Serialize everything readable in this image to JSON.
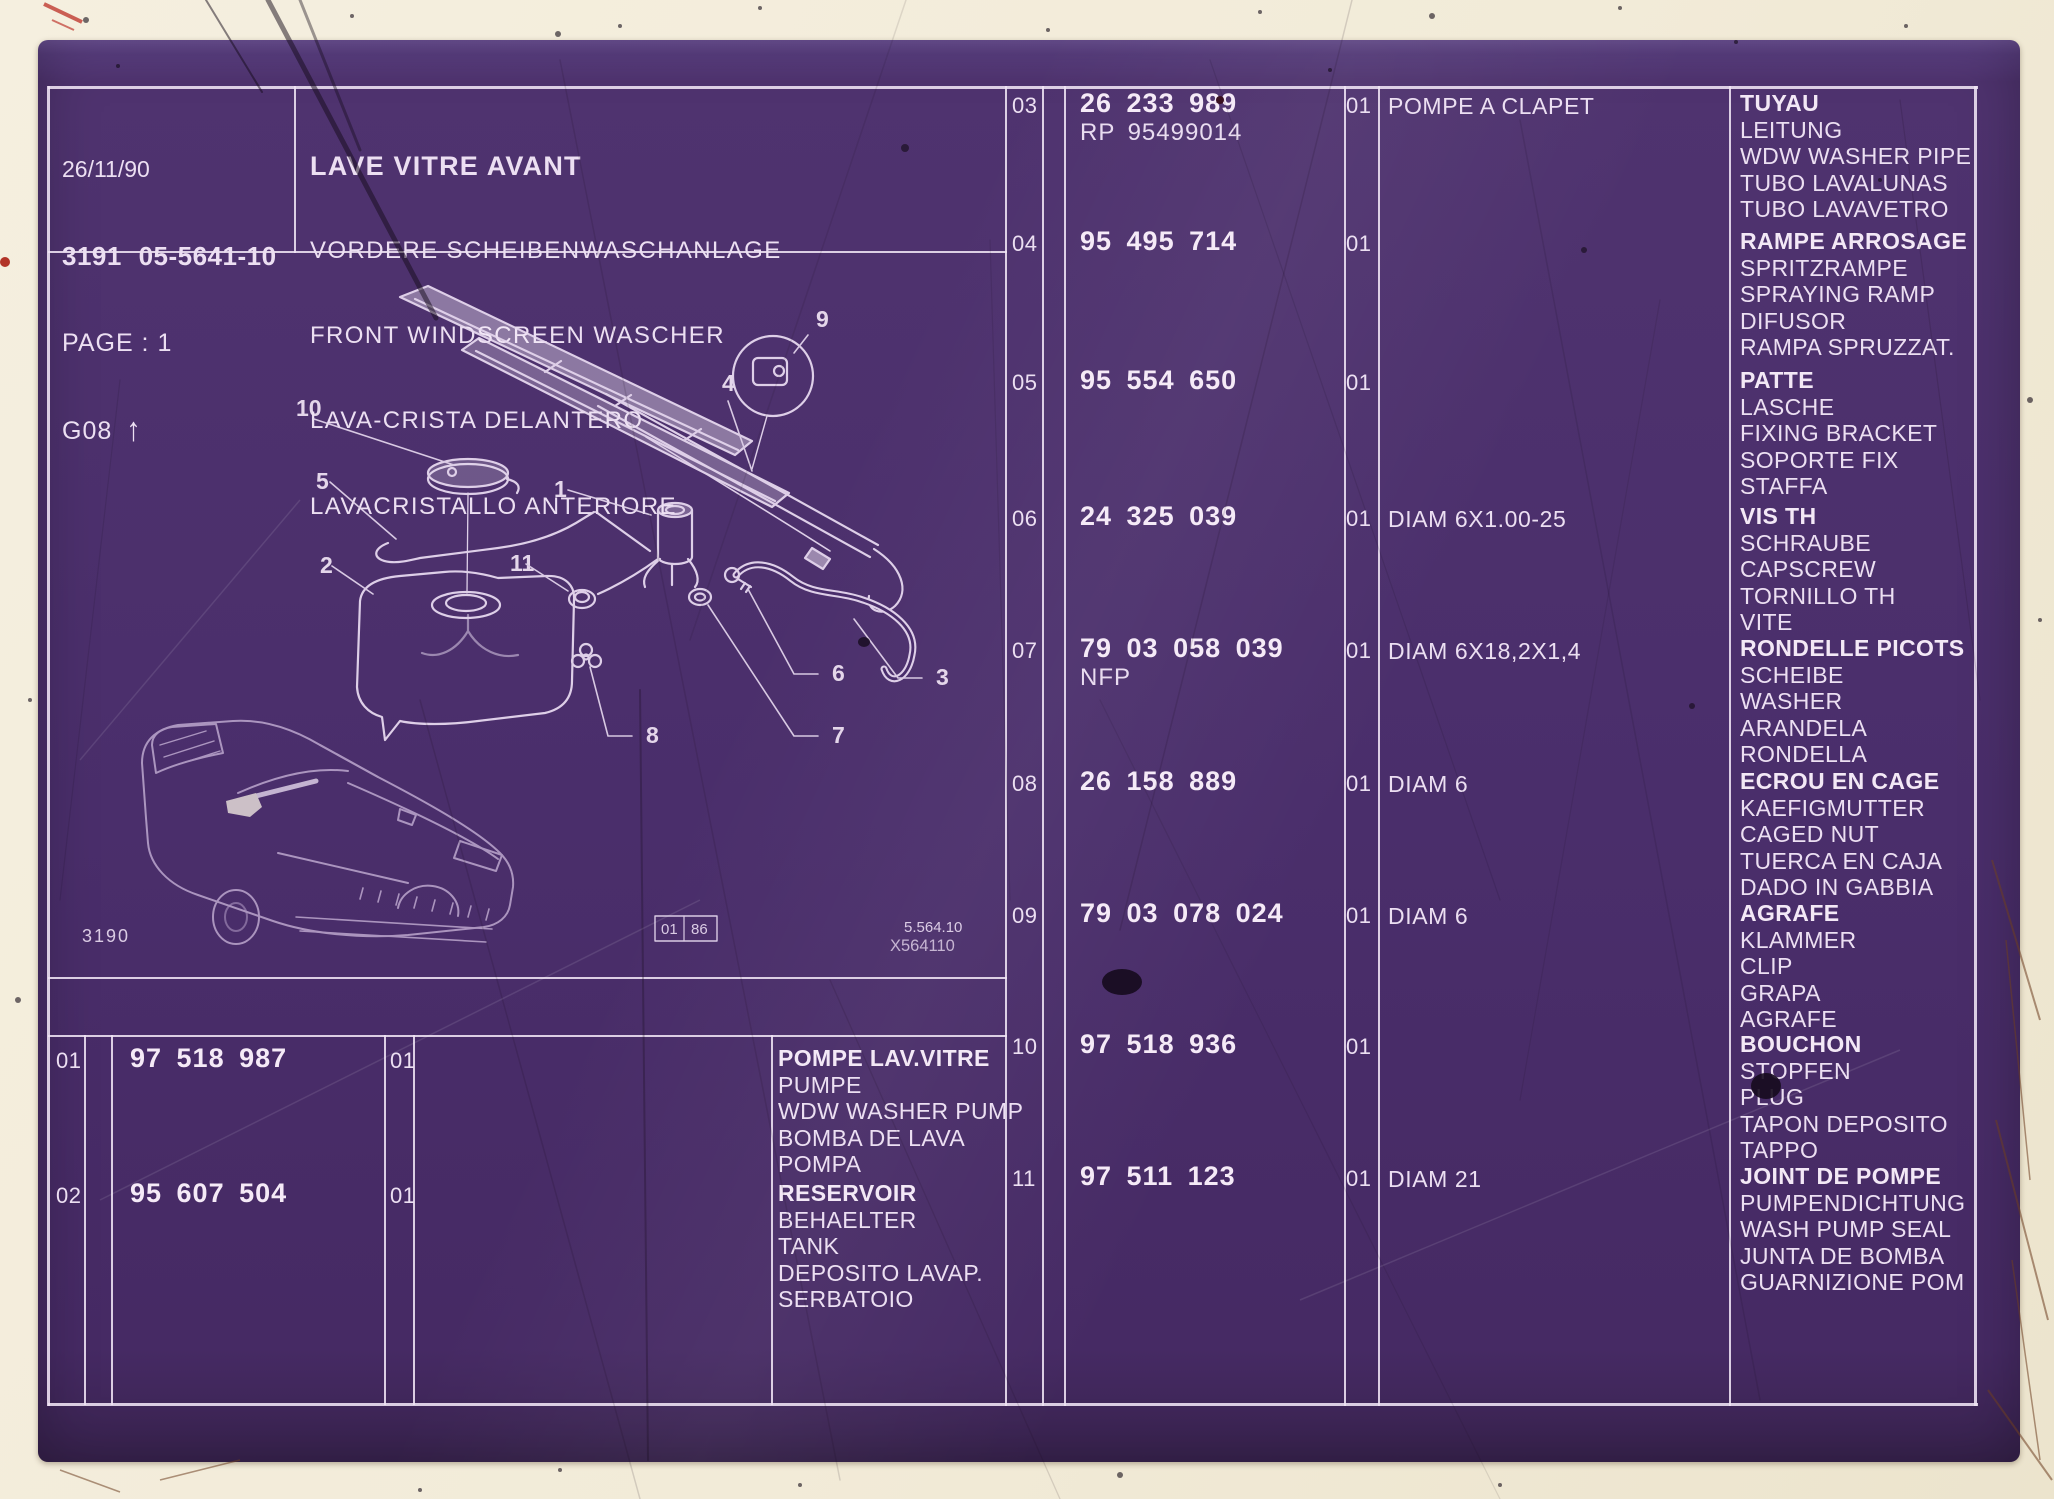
{
  "header": {
    "date": "26/11/90",
    "document_code": "3191 05-5641-10",
    "page": "PAGE : 1",
    "grid_ref": "G08",
    "grid_arrow": "↑"
  },
  "title": {
    "lines": [
      "LAVE VITRE AVANT",
      "VORDERE SCHEIBENWASCHANLAGE",
      "FRONT WINDSCREEN WASCHER",
      "LAVA-CRISTA DELANTERO",
      "LAVACRISTALLO ANTERIORE"
    ]
  },
  "drawing": {
    "callouts": [
      "1",
      "2",
      "3",
      "4",
      "5",
      "6",
      "7",
      "8",
      "9",
      "10",
      "11"
    ],
    "figure_number": "3190",
    "date_box_left": "01",
    "date_box_right": "86",
    "plate_ref_line1": "5.564.10",
    "plate_ref_line2": "X564110"
  },
  "parts_table_left": {
    "rows": [
      {
        "ref": "01",
        "part_lines": [
          "97 518 987"
        ],
        "qty": "01",
        "note": "",
        "descriptions": [
          "POMPE LAV.VITRE",
          "PUMPE",
          "WDW WASHER PUMP",
          "BOMBA DE LAVA",
          "POMPA"
        ]
      },
      {
        "ref": "02",
        "part_lines": [
          "95 607 504"
        ],
        "qty": "01",
        "note": "",
        "descriptions": [
          "RESERVOIR",
          "BEHAELTER",
          "TANK",
          "DEPOSITO LAVAP.",
          "SERBATOIO"
        ]
      }
    ]
  },
  "parts_table_right": {
    "rows": [
      {
        "ref": "03",
        "part_lines": [
          "26 233 989",
          "RP 95499014"
        ],
        "qty": "01",
        "note": "POMPE A CLAPET",
        "descriptions": [
          "TUYAU",
          "LEITUNG",
          "WDW WASHER PIPE",
          "TUBO LAVALUNAS",
          "TUBO LAVAVETRO"
        ]
      },
      {
        "ref": "04",
        "part_lines": [
          "95 495 714"
        ],
        "qty": "01",
        "note": "",
        "descriptions": [
          "RAMPE ARROSAGE",
          "SPRITZRAMPE",
          "SPRAYING RAMP",
          "DIFUSOR",
          "RAMPA SPRUZZAT."
        ]
      },
      {
        "ref": "05",
        "part_lines": [
          "95 554 650"
        ],
        "qty": "01",
        "note": "",
        "descriptions": [
          "PATTE",
          "LASCHE",
          "FIXING BRACKET",
          "SOPORTE FIX",
          "STAFFA"
        ]
      },
      {
        "ref": "06",
        "part_lines": [
          "24 325 039"
        ],
        "qty": "01",
        "note": "DIAM 6X1.00-25",
        "descriptions": [
          "VIS TH",
          "SCHRAUBE",
          "CAPSCREW",
          "TORNILLO TH",
          "VITE"
        ]
      },
      {
        "ref": "07",
        "part_lines": [
          "79 03 058 039",
          "NFP"
        ],
        "qty": "01",
        "note": "DIAM 6X18,2X1,4",
        "descriptions": [
          "RONDELLE PICOTS",
          "SCHEIBE",
          "WASHER",
          "ARANDELA",
          "RONDELLA"
        ]
      },
      {
        "ref": "08",
        "part_lines": [
          "26 158 889"
        ],
        "qty": "01",
        "note": "DIAM 6",
        "descriptions": [
          "ECROU EN CAGE",
          "KAEFIGMUTTER",
          "CAGED NUT",
          "TUERCA EN CAJA",
          "DADO IN GABBIA"
        ]
      },
      {
        "ref": "09",
        "part_lines": [
          "79 03 078 024"
        ],
        "qty": "01",
        "note": "DIAM 6",
        "descriptions": [
          "AGRAFE",
          "KLAMMER",
          "CLIP",
          "GRAPA",
          "AGRAFE"
        ]
      },
      {
        "ref": "10",
        "part_lines": [
          "97 518 936"
        ],
        "qty": "01",
        "note": "",
        "descriptions": [
          "BOUCHON",
          "STOPFEN",
          "PLUG",
          "TAPON DEPOSITO",
          "TAPPO"
        ]
      },
      {
        "ref": "11",
        "part_lines": [
          "97 511 123"
        ],
        "qty": "01",
        "note": "DIAM 21",
        "descriptions": [
          "JOINT DE POMPE",
          "PUMPENDICHTUNG",
          "WASH PUMP SEAL",
          "JUNTA DE BOMBA",
          "GUARNIZIONE POM"
        ]
      }
    ]
  },
  "colors": {
    "sheet_purple": "#4b2f6e",
    "line_ink": "#eee1f3",
    "paper": "#f2ecdb"
  }
}
